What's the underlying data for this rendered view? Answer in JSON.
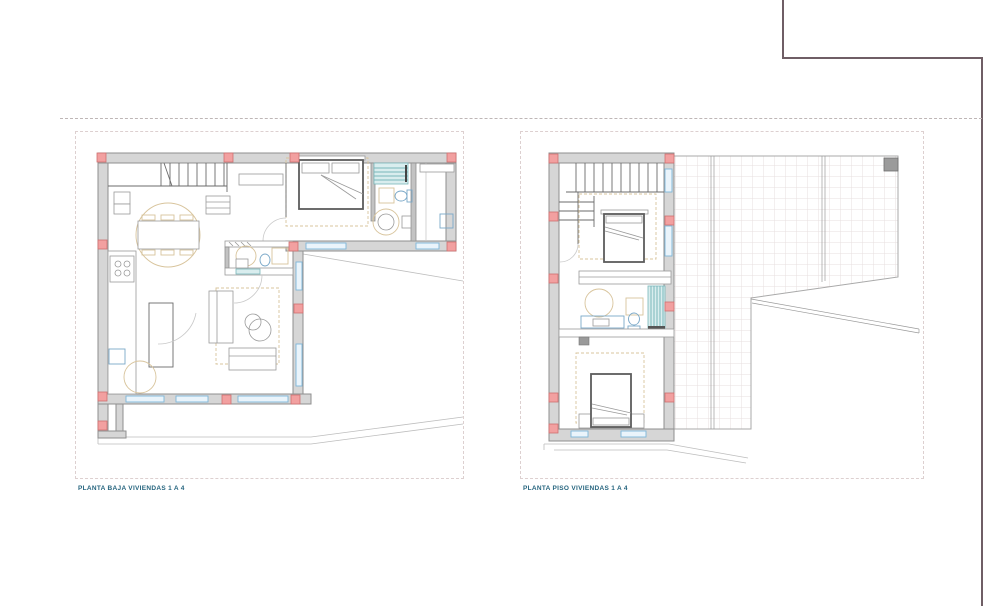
{
  "sheets": [
    {
      "id": "planta-baja",
      "label": "PLANTA BAJA VIVIENDAS 1 A 4"
    },
    {
      "id": "planta-piso",
      "label": "PLANTA PISO VIVIENDAS 1 A 4"
    }
  ],
  "colors": {
    "wall_fill": "#d6d6d6",
    "wall_stroke": "#8f8f8f",
    "column_fill": "#f2a0a0",
    "column_stroke": "#cf7070",
    "window_blue": "#7db6d9",
    "furniture_beige": "#d8c49c",
    "shower_teal_fill": "#d9edee",
    "shower_teal_stroke": "#79b6ba",
    "terrace_tile_line": "#e7dfdf",
    "frame_line": "#6f5e65",
    "label_text": "#25647e",
    "sheet_border": "#ddd0d0"
  }
}
